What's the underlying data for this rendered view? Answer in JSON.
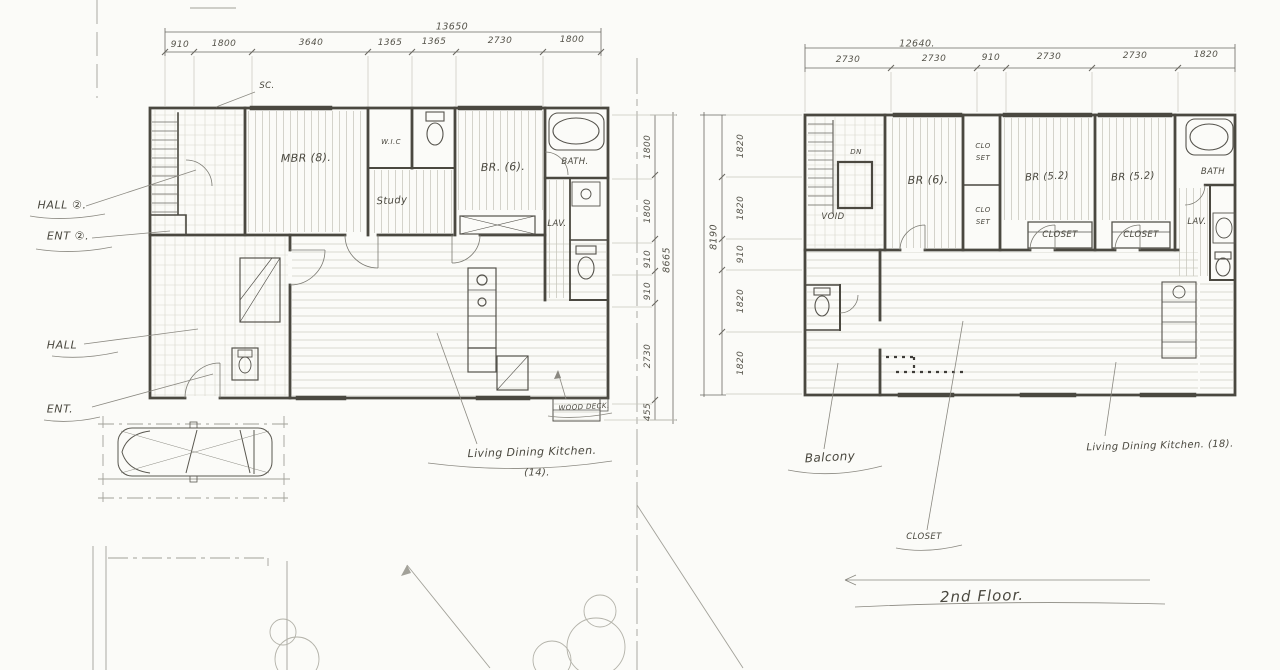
{
  "plan1": {
    "dims_top": {
      "total": "13650",
      "segments": [
        "910",
        "1800",
        "3640",
        "1365",
        "1365",
        "2730",
        "1800"
      ]
    },
    "dims_right": {
      "total": "8665",
      "segments": [
        "1800",
        "1800",
        "910",
        "910",
        "2730",
        "455"
      ]
    },
    "rooms": {
      "sc": "SC.",
      "mbr": "MBR (8).",
      "wic": "W.I.C",
      "study": "Study",
      "br": "BR. (6).",
      "bath": "BATH.",
      "lav": "LAV.",
      "wood_deck": "WOOD DECK.",
      "ldk": "Living Dining Kitchen.",
      "ldk_area": "(14)."
    },
    "side": {
      "hall2": "HALL ②.",
      "ent2": "ENT ②.",
      "hall": "HALL",
      "ent": "ENT."
    }
  },
  "plan2": {
    "dims_top": {
      "total": "12640.",
      "segments": [
        "2730",
        "2730",
        "910",
        "2730",
        "2730",
        "1820"
      ]
    },
    "dims_left": {
      "total": "8190",
      "segments": [
        "1820",
        "1820",
        "910",
        "1820",
        "1820"
      ]
    },
    "rooms": {
      "dn": "DN",
      "void": "VOID",
      "br6": "BR (6).",
      "clo": "CLO",
      "set": "SET",
      "br52a": "BR (5.2)",
      "br52b": "BR (5.2)",
      "closet_a": "CLOSET",
      "closet_b": "CLOSET",
      "bath": "BATH",
      "lav": "LAV.",
      "balcony": "Balcony",
      "closet_note": "CLOSET",
      "ldk": "Living Dining Kitchen. (18)."
    },
    "title": "2nd Floor."
  }
}
